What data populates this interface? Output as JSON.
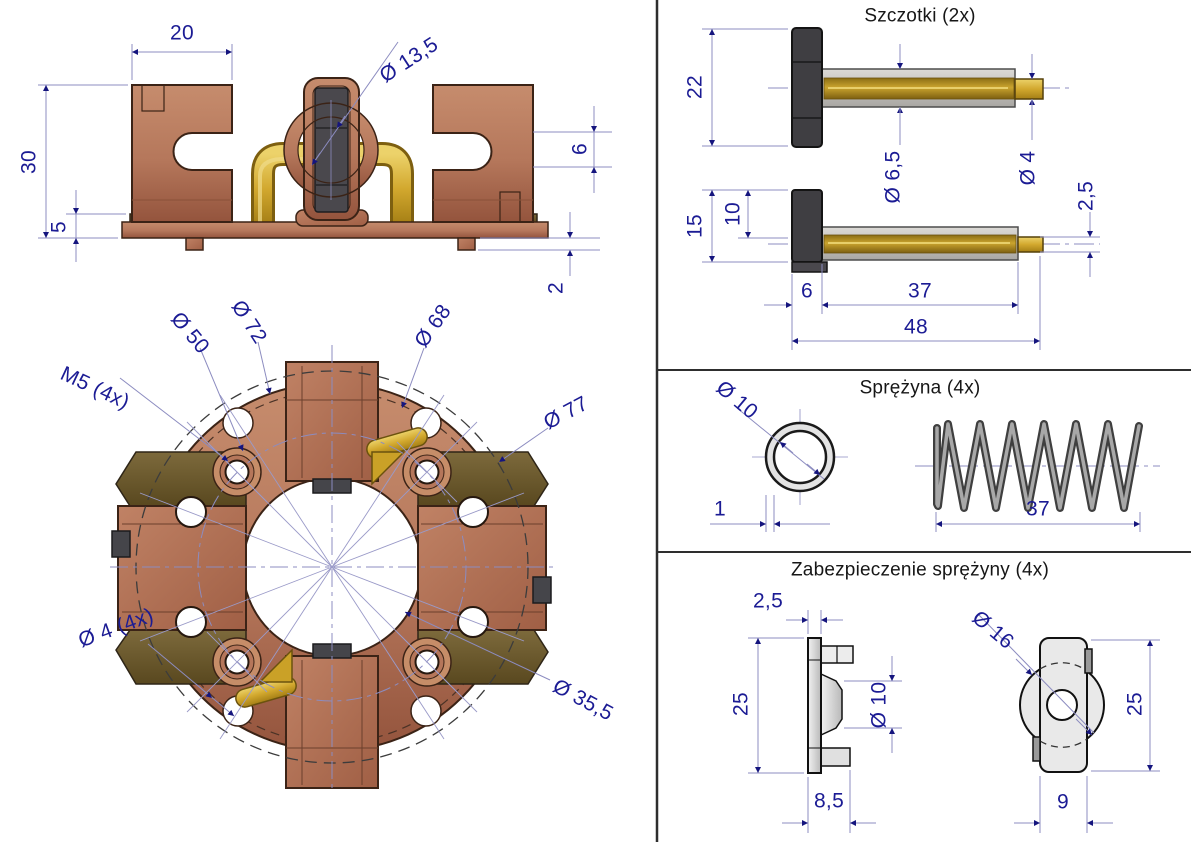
{
  "colors": {
    "copper": "#b5775b",
    "olive": "#6f5c33",
    "brass": "#d2a82e",
    "steel_gray": "#c7c5c1",
    "dim_text": "#1b1b94",
    "construction_line": "#8c8cc0",
    "outline": "#3b2316"
  },
  "left": {
    "front_view": {
      "name": "brush-holder-front-elevation",
      "dims": {
        "bracket_width": "20",
        "total_height": "30",
        "base_height": "5",
        "ring_dia": "Ø 13,5",
        "slot_height": "6",
        "foot_height": "2"
      }
    },
    "plan_view": {
      "name": "brush-holder-plan-view",
      "dims": {
        "thread": "M5 (4x)",
        "bolt_circle": "Ø 50",
        "ring_outer": "Ø 72",
        "notch_circle": "Ø 68",
        "outer_dia": "Ø 77",
        "bore_dia": "Ø 35,5",
        "small_hole": "Ø 4 (4x)"
      }
    }
  },
  "right": {
    "brushes": {
      "title": "Szczotki (2x)",
      "dims": {
        "brush_height": "22",
        "shunt_dia": "Ø 6,5",
        "tip_dia": "Ø 4",
        "tip2_dia": "2,5",
        "brush2_height": "15",
        "lead_offset": "10",
        "block_width": "6",
        "shunt_length": "37",
        "total_length": "48"
      }
    },
    "spring": {
      "title": "Sprężyna (4x)",
      "dims": {
        "outer_dia": "Ø 10",
        "wire_dia": "1",
        "length": "37"
      }
    },
    "retainer": {
      "title": "Zabezpieczenie sprężyny (4x)",
      "dims": {
        "plate_thickness": "2,5",
        "height_left": "25",
        "boss_dia": "Ø 10",
        "foot_width": "8,5",
        "disc_dia": "Ø 16",
        "height_right": "25",
        "body_width": "9"
      }
    }
  }
}
